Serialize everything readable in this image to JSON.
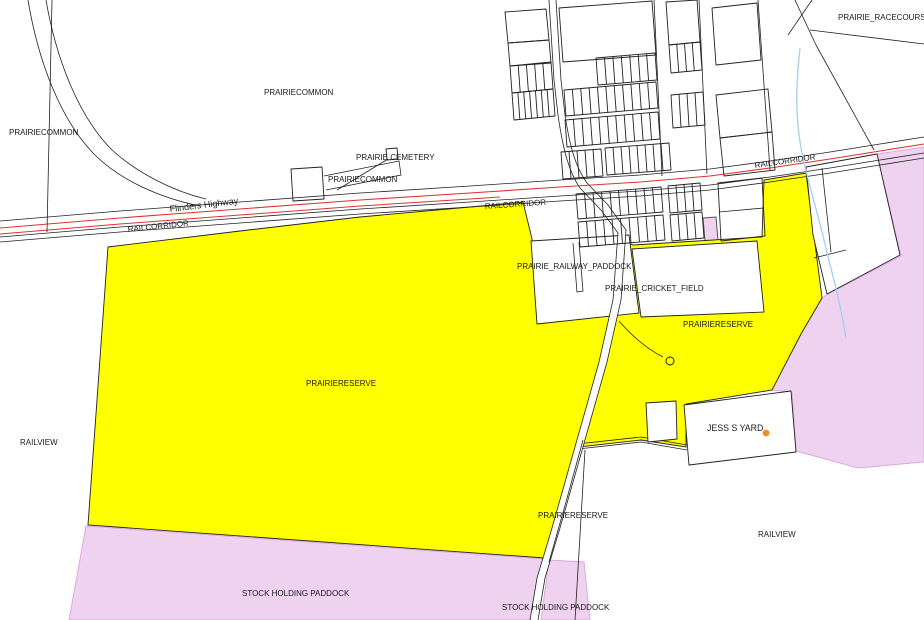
{
  "map": {
    "colors": {
      "background": "#ffffff",
      "parcel_line": "#222222",
      "reserve_yellow": "#ffff00",
      "paddock_pink": "#efd2ef",
      "pink_border": "#dfa8df",
      "highway_red": "#e03131",
      "creek_blue": "#a5cfee",
      "poi_orange": "#f08c28",
      "label_color": "#1a1a1a"
    },
    "labels": [
      {
        "text": "PRAIRIE_RACECOURSE"
      },
      {
        "text": "PRAIRIECOMMON"
      },
      {
        "text": "PRAIRIECOMMON"
      },
      {
        "text": "PRAIRIE CEMETERY"
      },
      {
        "text": "PRAIRIECOMMON"
      },
      {
        "text": "Flinders Highway"
      },
      {
        "text": "RAILCORRIDOR"
      },
      {
        "text": "RAILCORRIDOR"
      },
      {
        "text": "RAILCORRIDOR"
      },
      {
        "text": "PRAIRIE_RAILWAY_PADDOCK"
      },
      {
        "text": "PRAIRIE_CRICKET_FIELD"
      },
      {
        "text": "PRAIRIERESERVE"
      },
      {
        "text": "PRAIRIERESERVE"
      },
      {
        "text": "JESS S YARD"
      },
      {
        "text": "RAILVIEW"
      },
      {
        "text": "PRAIRIERESERVE"
      },
      {
        "text": "RAILVIEW"
      },
      {
        "text": "STOCK HOLDING PADDOCK"
      },
      {
        "text": "STOCK HOLDING PADDOCK"
      }
    ]
  }
}
